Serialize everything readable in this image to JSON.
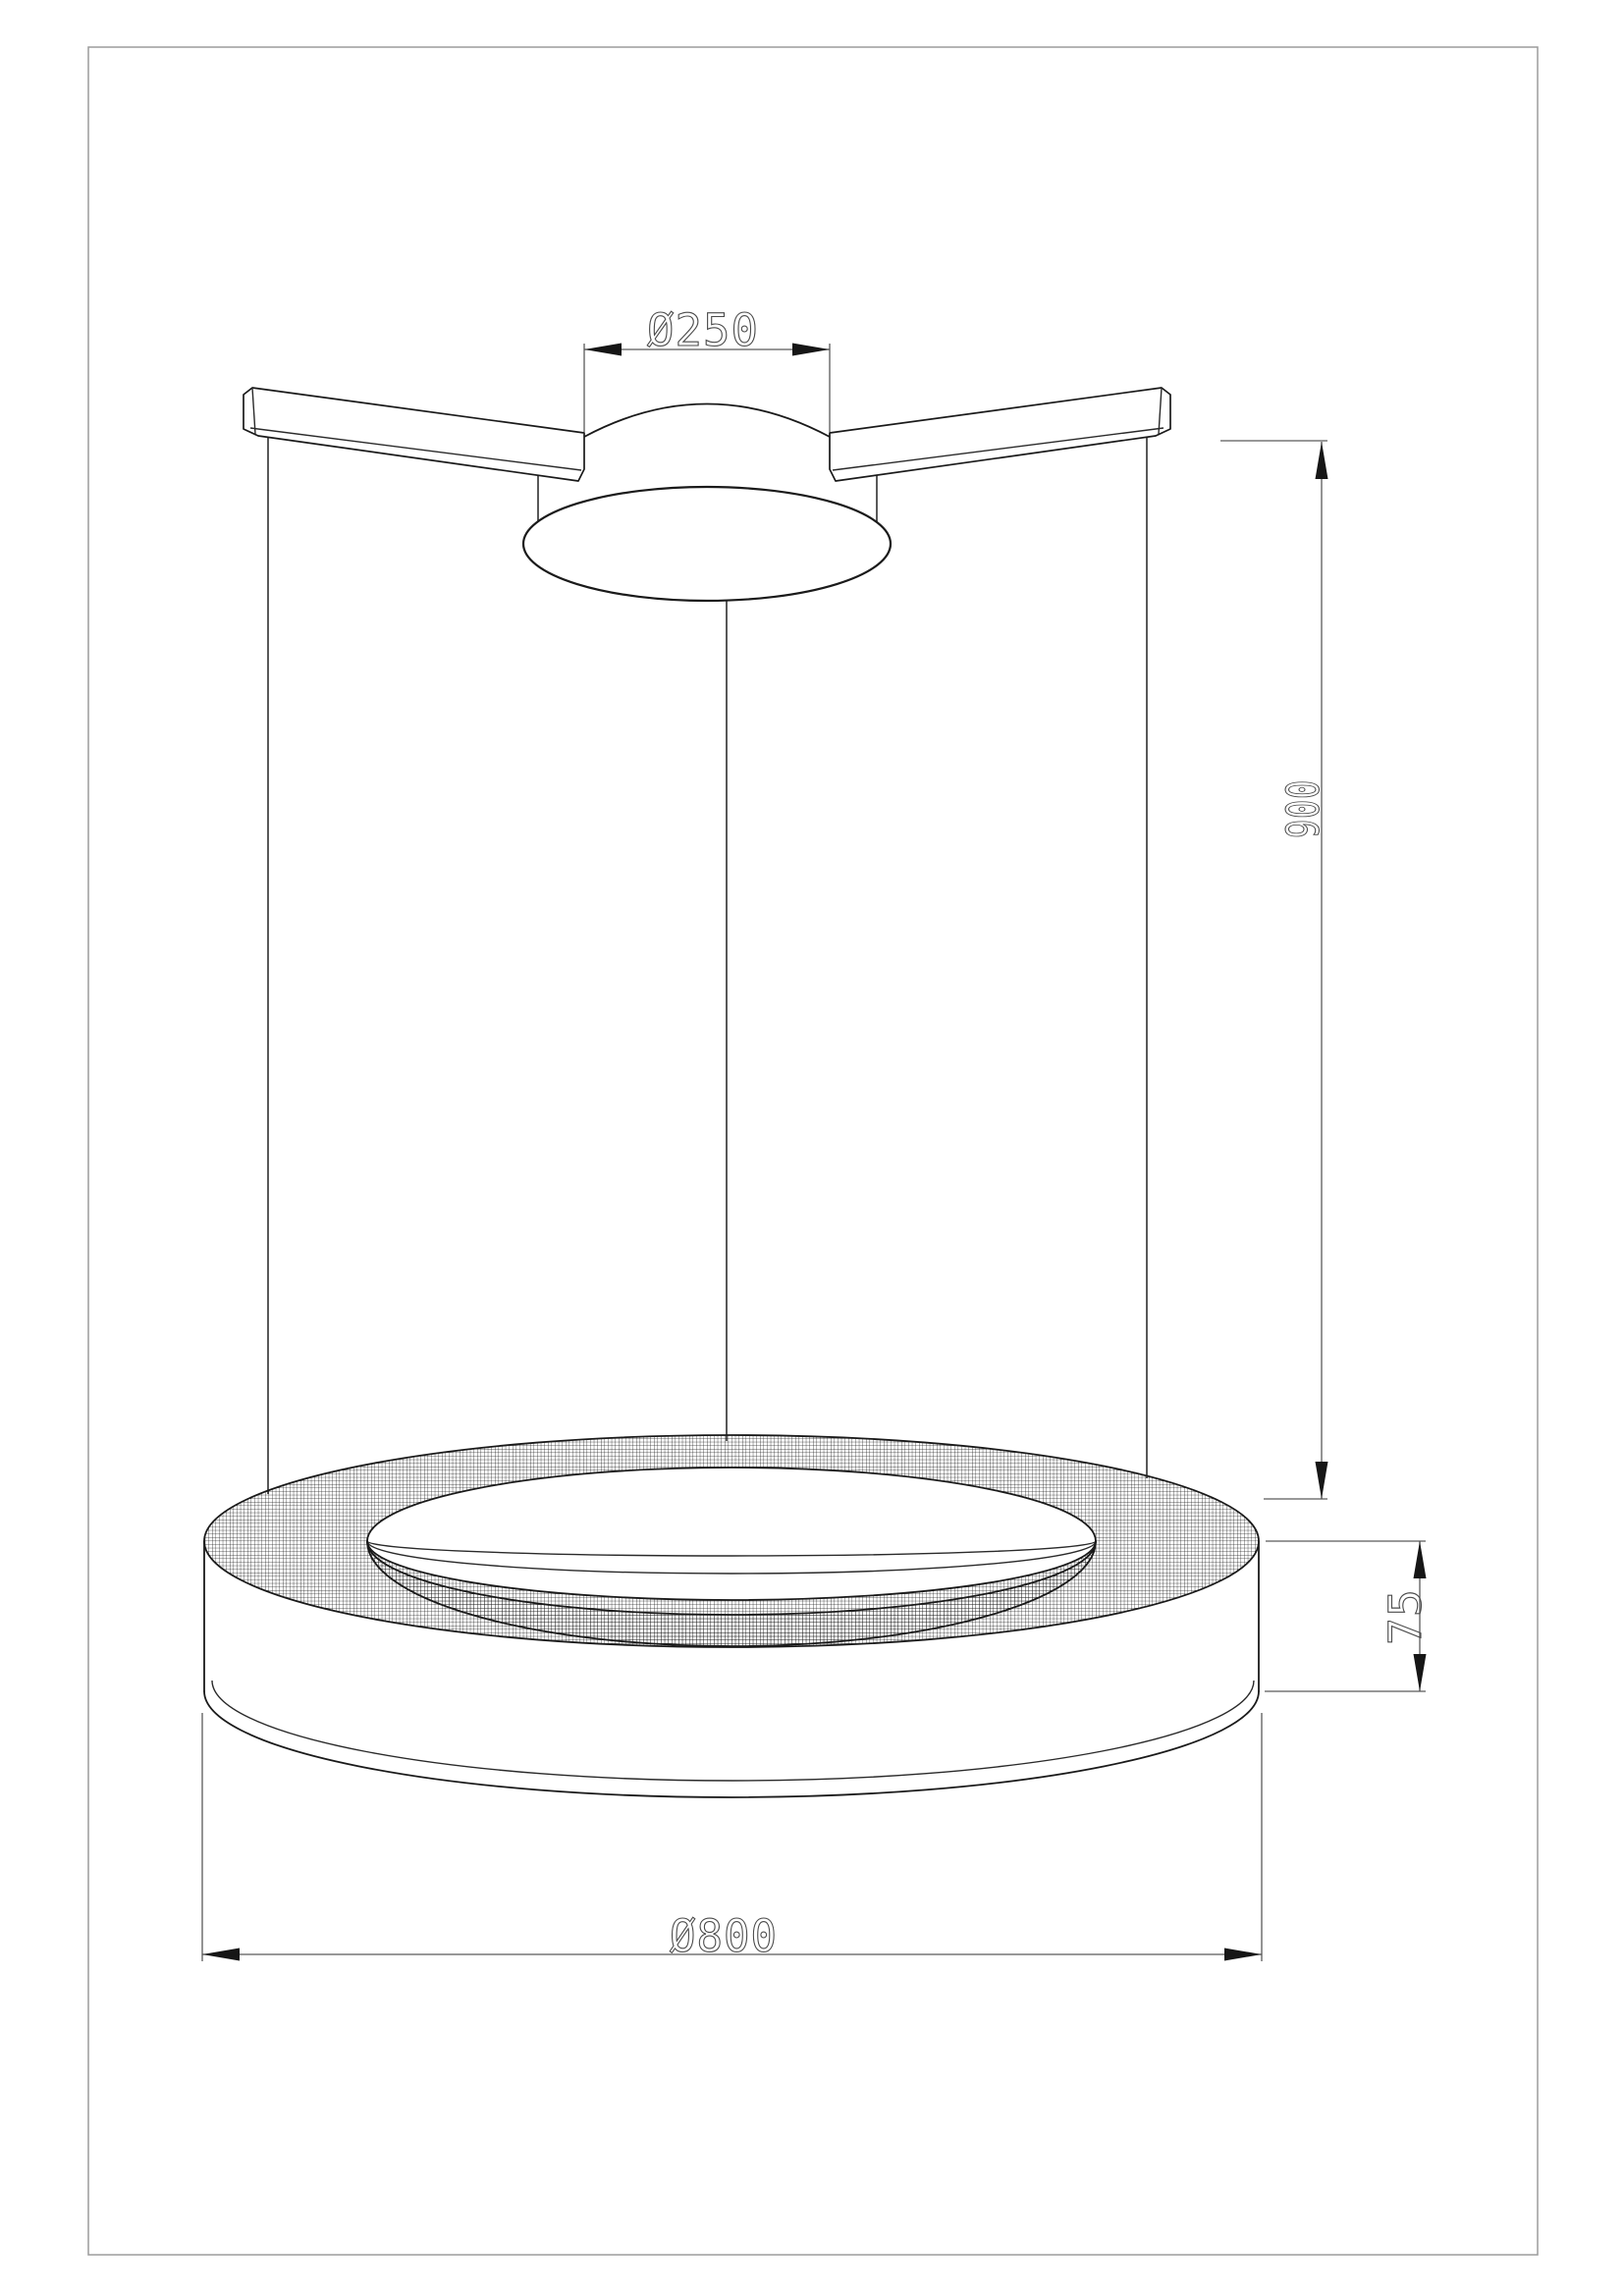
{
  "drawing": {
    "title": "pendant-ring-luminaire-dimension-drawing",
    "dimensions": {
      "canopy_diameter": {
        "label": "Ø250",
        "value": 250,
        "unit": "mm",
        "measures": "ceiling-canopy-diameter"
      },
      "suspension_height": {
        "label": "900",
        "value": 900,
        "unit": "mm",
        "measures": "drop-height-canopy-to-ring"
      },
      "ring_height": {
        "label": "75",
        "value": 75,
        "unit": "mm",
        "measures": "ring-profile-height"
      },
      "ring_diameter": {
        "label": "Ø800",
        "value": 800,
        "unit": "mm",
        "measures": "ring-outer-diameter"
      }
    },
    "colors": {
      "background": "#ffffff",
      "object_line": "#1a1a1a",
      "dimension_line": "#5a5a5a",
      "dimension_text": "#4a4a4a",
      "arrowhead": "#161616",
      "page_border": "#9c9c9c",
      "hatch": "#1c1c1c"
    }
  }
}
